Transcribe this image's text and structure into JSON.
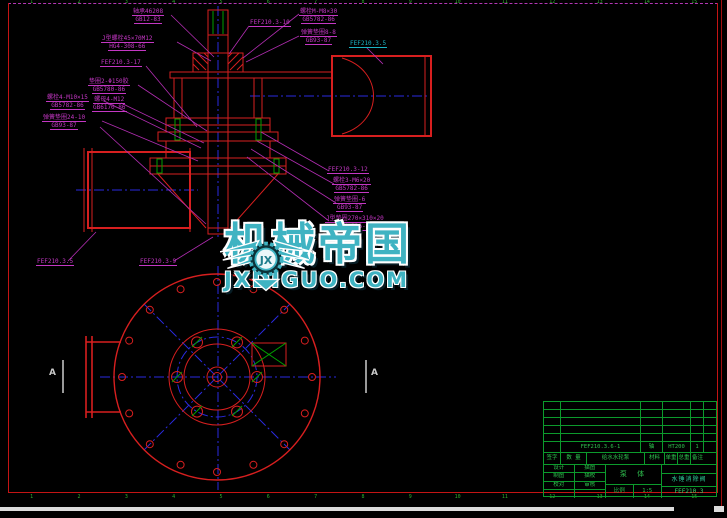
{
  "watermark": {
    "brand": "机械帝国",
    "domain": "JXDIGUO.COM",
    "monogram": "JX",
    "color": "#3fb3c2"
  },
  "border": {
    "top_zones": [
      "1",
      "2",
      "3",
      "4",
      "5",
      "6",
      "7",
      "8",
      "9",
      "10",
      "11",
      "12",
      "13",
      "14",
      "15"
    ],
    "bottom_zones": [
      "1",
      "2",
      "3",
      "4",
      "5",
      "6",
      "7",
      "8",
      "9",
      "10",
      "11",
      "12",
      "13",
      "14",
      "15"
    ]
  },
  "section_marks": {
    "left": "A",
    "right": "A"
  },
  "annotations": [
    {
      "line1": "轴承46208",
      "line2": "GB12-83"
    },
    {
      "line1": "J型螺栓45×70M12",
      "line2": "HG4-308-66"
    },
    {
      "line1": "FEF210.3-17",
      "line2": ""
    },
    {
      "line1": "FEF210.3-10",
      "line2": ""
    },
    {
      "line1": "螺栓M-M8×30",
      "line2": "GB5782-86"
    },
    {
      "line1": "弹簧垫圈8-8",
      "line2": "GB93-87"
    },
    {
      "line1": "FEF210.3.5",
      "line2": ""
    },
    {
      "line1": "垫圈2-Φ150胶",
      "line2": "GB5780-86"
    },
    {
      "line1": "螺栓4-M10×15",
      "line2": "GB5782-86"
    },
    {
      "line1": "螺母4-M12",
      "line2": "GB6170-86"
    },
    {
      "line1": "弹簧垫圈24-10",
      "line2": "GB93-87"
    },
    {
      "line1": "FEF210.3-12",
      "line2": ""
    },
    {
      "line1": "螺栓3-M6×20",
      "line2": "GB5782-86"
    },
    {
      "line1": "弹簧垫圈-6",
      "line2": "GB93-87"
    },
    {
      "line1": "J型垫圈270×310×20",
      "line2": "HG4-326-66"
    },
    {
      "line1": "FEF210.3.5",
      "line2": ""
    },
    {
      "line1": "FEF210.3-9",
      "line2": ""
    }
  ],
  "title_block": {
    "bom_row": [
      "",
      "FEF210.3.6-1",
      "轴",
      "HT200",
      "1",
      ""
    ],
    "header": [
      "签字",
      "数 量",
      "给水水轮泵",
      "材料",
      "单重",
      "总重",
      "备注"
    ],
    "sign_rows": [
      [
        "设计",
        "描图"
      ],
      [
        "制图",
        "描校"
      ],
      [
        "校对",
        "审核"
      ],
      [
        "",
        ""
      ]
    ],
    "center_label": "泵 体",
    "scale_label": "比例",
    "scale_value": "1:5",
    "product_name": "水锤消除阀",
    "drawing_no": "FEF210.3"
  }
}
